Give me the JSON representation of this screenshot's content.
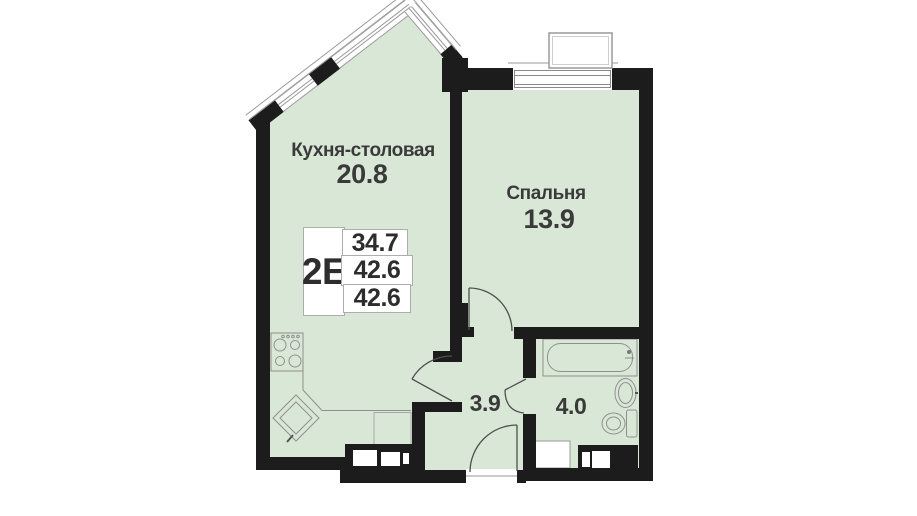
{
  "info_card": {
    "unit_type": "2E",
    "rows": [
      "34.7",
      "42.6",
      "42.6"
    ]
  },
  "rooms": {
    "kitchen": {
      "label": "Кухня-столовая",
      "area": "20.8"
    },
    "bedroom": {
      "label": "Спальня",
      "area": "13.9"
    },
    "hallway": {
      "area": "3.9"
    },
    "bathroom": {
      "area": "4.0"
    }
  },
  "fixtures": [
    "stove",
    "kitchen-sink",
    "counter",
    "fridge-space",
    "bathtub",
    "washbasin",
    "toilet",
    "washing-machine",
    "ventilation-shaft",
    "ac-basket",
    "entrance-door",
    "interior-door",
    "window"
  ],
  "colors": {
    "room_fill": "#d9e8d6",
    "wall": "#1c1c1c",
    "fixture_line": "#8f8f8f",
    "text": "#3a3a3a",
    "card_border": "#adadad"
  }
}
